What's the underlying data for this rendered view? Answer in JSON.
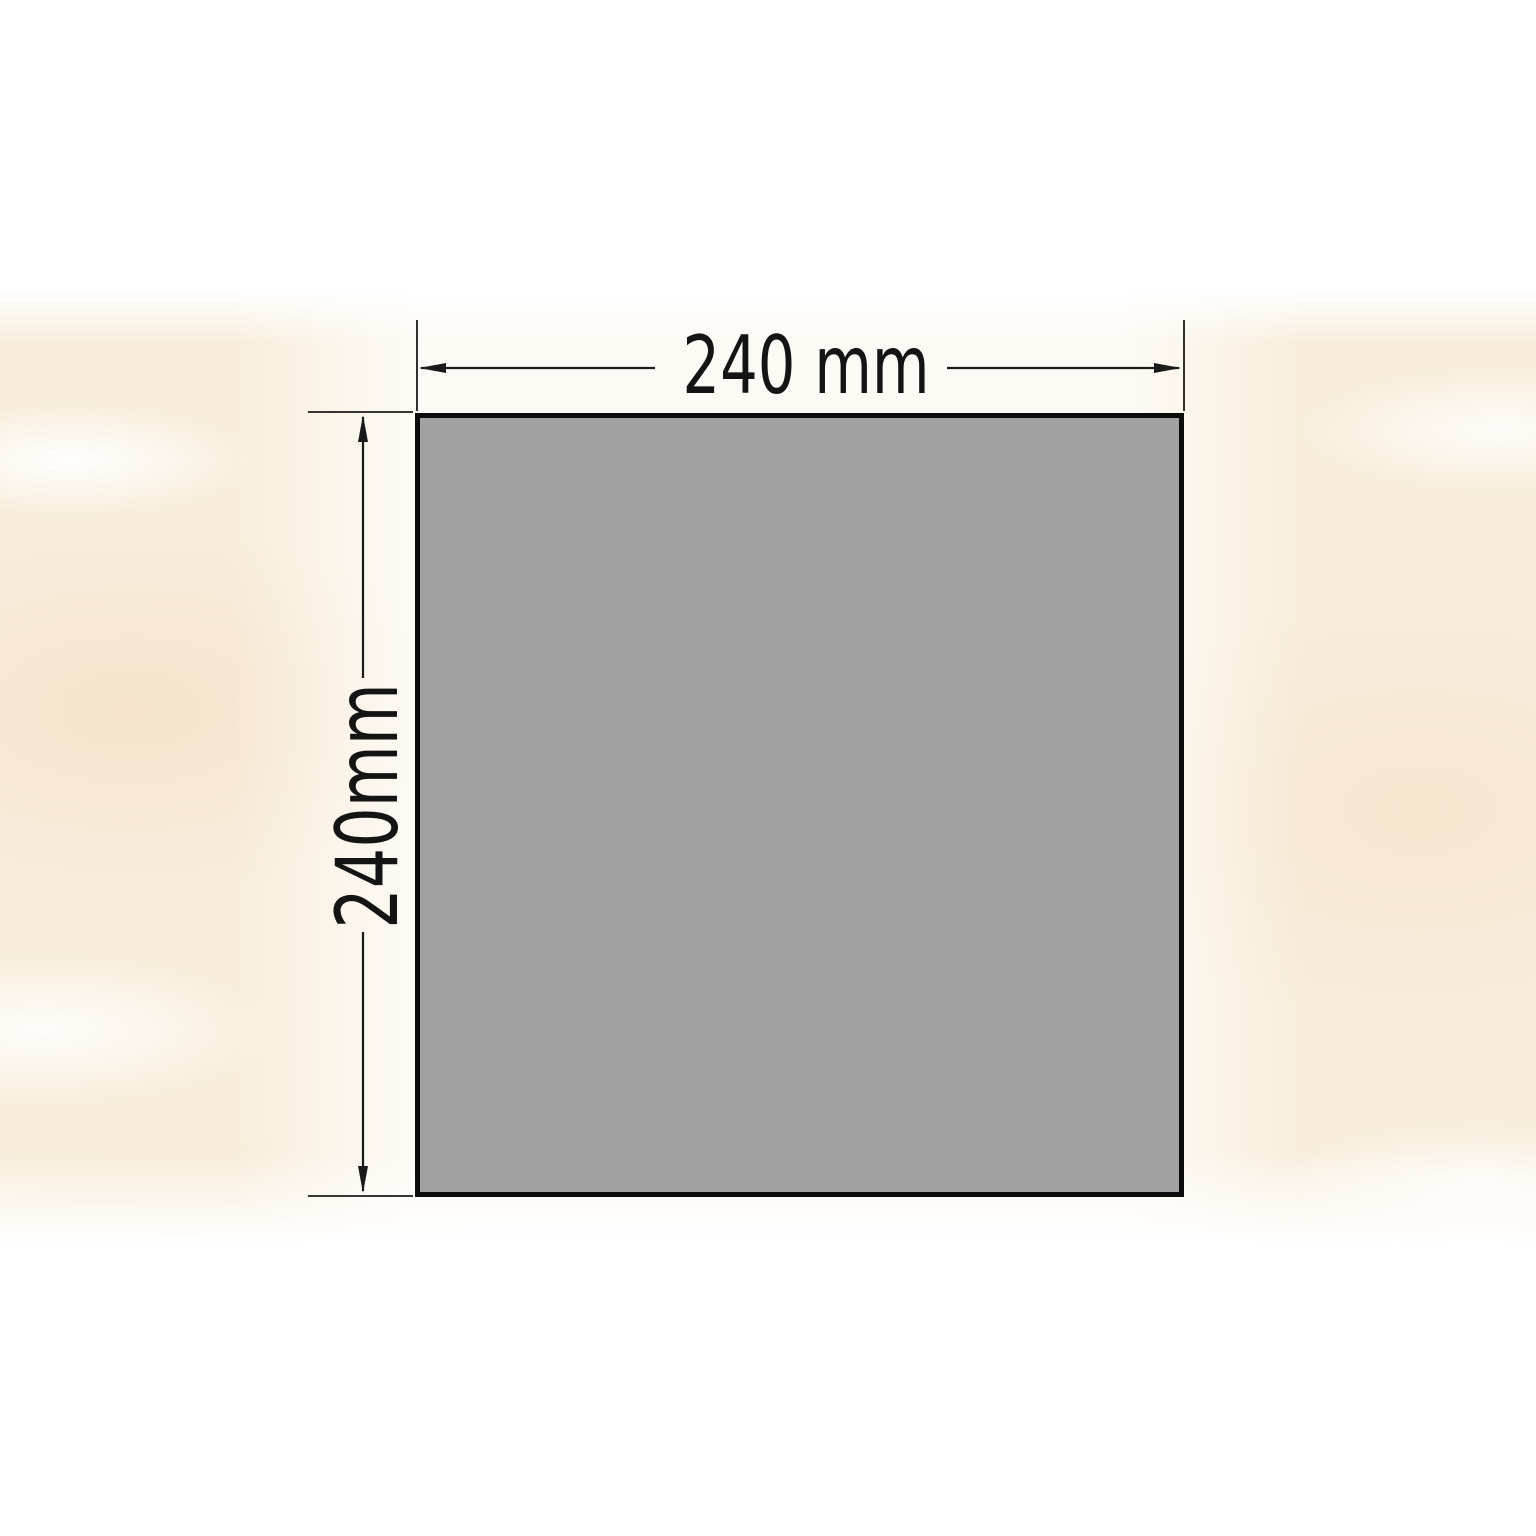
{
  "diagram": {
    "type": "product-dimension-drawing",
    "shape": "square-tile",
    "width_label": "240 mm",
    "height_label": "240mm",
    "width_value_mm": 240,
    "height_value_mm": 240
  },
  "colors": {
    "page_background": "#ffffff",
    "marble_base": "#f8eddb",
    "tile_fill": "#a1a1a1",
    "tile_border": "#0c0c0c",
    "dimension_line": "#1a1a1a",
    "label_text": "#141414"
  }
}
